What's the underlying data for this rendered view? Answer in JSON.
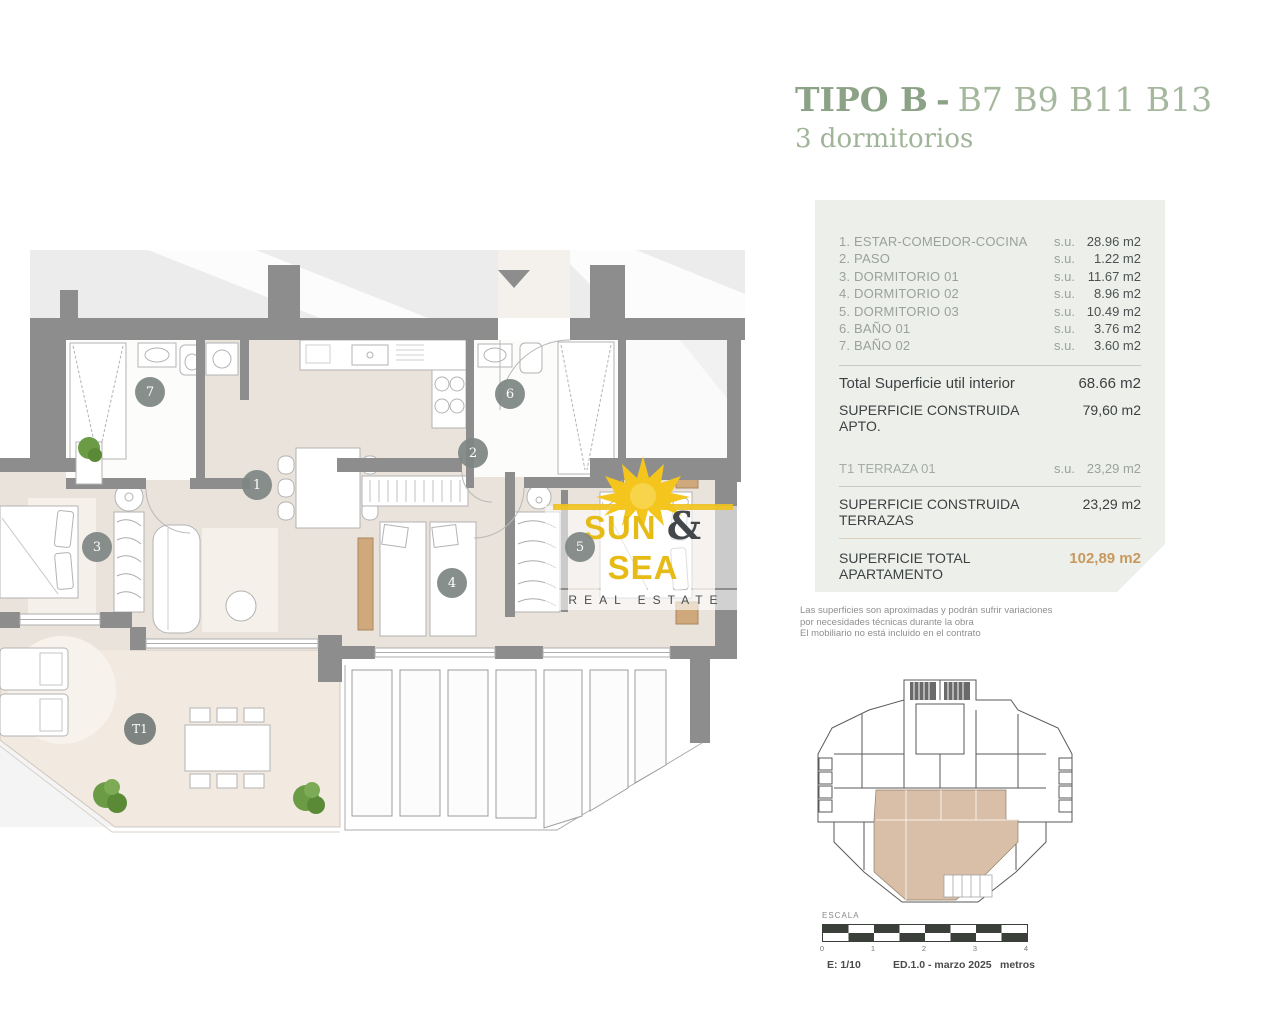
{
  "title": {
    "main": "TIPO B",
    "sep": "-",
    "units": "B7 B9 B11 B13",
    "subtitle": "3 dormitorios"
  },
  "logo": {
    "word1": "SUN",
    "amp": "&",
    "word2": "SEA",
    "tagline": "REAL ESTATE"
  },
  "surface_table": {
    "rows": [
      {
        "name": "1. ESTAR-COMEDOR-COCINA",
        "su": "s.u.",
        "value": "28.96 m2"
      },
      {
        "name": "2. PASO",
        "su": "s.u.",
        "value": "1.22 m2"
      },
      {
        "name": "3. DORMITORIO 01",
        "su": "s.u.",
        "value": "11.67 m2"
      },
      {
        "name": "4. DORMITORIO 02",
        "su": "s.u.",
        "value": "8.96 m2"
      },
      {
        "name": "5. DORMITORIO 03",
        "su": "s.u.",
        "value": "10.49 m2"
      },
      {
        "name": "6. BAÑO 01",
        "su": "s.u.",
        "value": "3.76 m2"
      },
      {
        "name": "7. BAÑO 02",
        "su": "s.u.",
        "value": "3.60 m2"
      }
    ],
    "total_util_label": "Total Superficie util interior",
    "total_util_value": "68.66 m2",
    "construida_apto_label": "SUPERFICIE CONSTRUIDA APTO.",
    "construida_apto_value": "79,60 m2",
    "terraza_label": "T1 TERRAZA 01",
    "terraza_su": "s.u.",
    "terraza_value": "23,29 m2",
    "construida_terrazas_label": "SUPERFICIE CONSTRUIDA TERRAZAS",
    "construida_terrazas_value": "23,29 m2",
    "total_label": "SUPERFICIE TOTAL APARTAMENTO",
    "total_value": "102,89 m2"
  },
  "disclaimer": {
    "lines": [
      "Las superficies son aproximadas y podrán sufrir variaciones",
      "por necesidades técnicas durante la obra",
      "El mobiliario no está incluido en el contrato"
    ]
  },
  "floorplan": {
    "badges": {
      "b1": "1",
      "b2": "2",
      "b3": "3",
      "b4": "4",
      "b5": "5",
      "b6": "6",
      "b7": "7",
      "t1": "T1"
    }
  },
  "scalebar": {
    "label": "ESCALA",
    "ticks": [
      "0",
      "1",
      "2",
      "3",
      "4"
    ],
    "scale": "E: 1/10",
    "edition": "ED.1.0 - marzo 2025",
    "units": "metros"
  },
  "colors": {
    "accent_green": "#8ba286",
    "accent_green_light": "#a5b89e",
    "accent_orange": "#c8995f",
    "panel_bg": "#edf0ea",
    "wall_gray": "#8d8d8d",
    "floor_beige": "#eae3db",
    "terrace_beige": "#f2e9e1",
    "unit_highlight_tan": "#d9bfa7",
    "logo_yellow": "#f3c51d"
  }
}
